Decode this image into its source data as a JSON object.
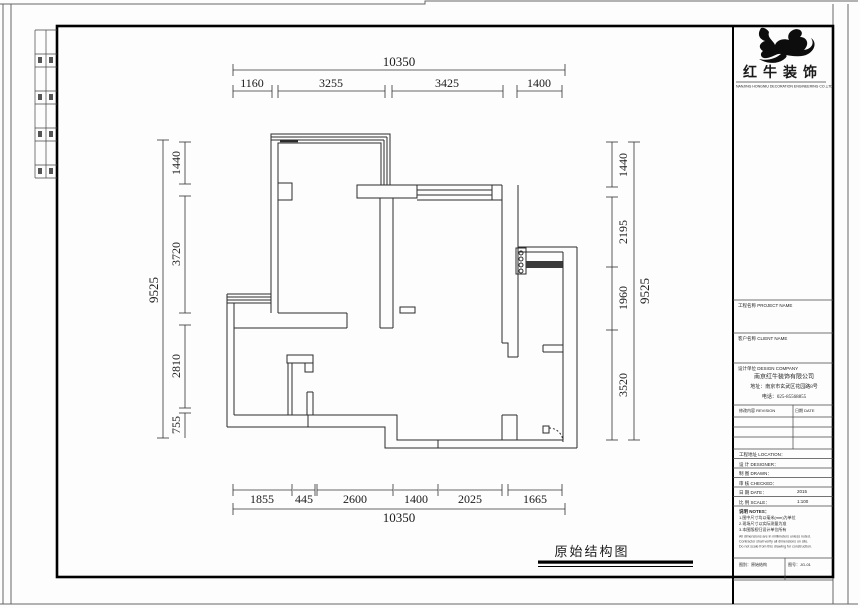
{
  "caption": {
    "text": "原始结构图"
  },
  "dims": {
    "top": {
      "overall": "10350",
      "segments": [
        "1160",
        "3255",
        "3425",
        "1400"
      ]
    },
    "bottom": {
      "overall": "10350",
      "segments": [
        "1855",
        "445",
        "2600",
        "1400",
        "2025",
        "1665"
      ]
    },
    "left": {
      "overall": "9525",
      "segments": [
        "1440",
        "3720",
        "2810",
        "755"
      ]
    },
    "right": {
      "overall": "9525",
      "segments": [
        "1440",
        "2195",
        "1960",
        "3520"
      ]
    }
  },
  "title_block": {
    "brand": {
      "name": "红牛装饰",
      "subtitle": "NANJING HONGNIU DECORATION ENGINEERING CO.,LTD"
    },
    "section_labels": [
      "工程名称 PROJECT NAME",
      "客户名称 CLIENT NAME",
      "设计单位 DESIGN COMPANY"
    ],
    "company": {
      "name": "南京红牛装饰有限公司",
      "address": "地址：南京市玄武区花园路8号",
      "phone": "电话：025-85568855"
    },
    "revision_header": {
      "col1": "修改内容 REVISION",
      "col2": "日期 DATE"
    },
    "rows": [
      {
        "label": "工程地址 LOCATION：",
        "value": ""
      },
      {
        "label": "设 计 DESIGNER：",
        "value": ""
      },
      {
        "label": "制 图 DRAWN：",
        "value": ""
      },
      {
        "label": "审 核 CHECKED：",
        "value": ""
      },
      {
        "label": "日 期 DATE：",
        "value": "2015"
      },
      {
        "label": "比 例 SCALE：",
        "value": "1:100"
      }
    ],
    "notes": {
      "header": "说明 NOTES：",
      "lines": [
        "1.图中尺寸均以毫米(mm)为单位",
        "2.现场尺寸以实际测量为准",
        "3.本图版权归设计单位所有"
      ],
      "small_lines": [
        "All dimensions are in millimeters unless noted.",
        "Contractor shall verify all dimensions on site.",
        "Do not scale from this drawing for construction."
      ]
    },
    "footer": {
      "left": "图别：原始结构",
      "right": "图号：JG-01"
    }
  },
  "colors": {
    "wall": "#2b2b2b",
    "frame": "#000000",
    "dim": "#333333",
    "hatch": "#3a3a3a"
  }
}
